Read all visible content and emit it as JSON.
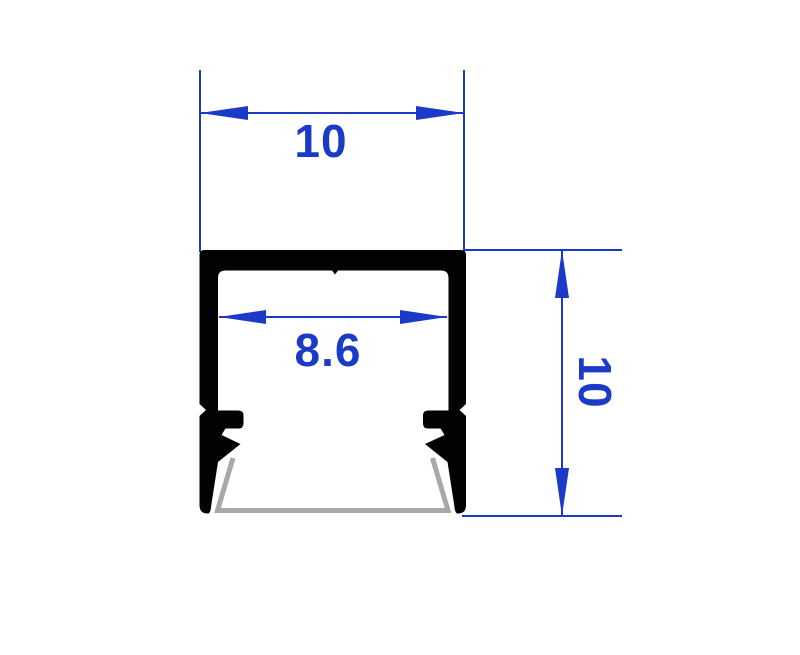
{
  "drawing": {
    "title": "LED profile cross-section",
    "dimensions": {
      "outer_width": {
        "label": "10",
        "value": 10
      },
      "inner_width": {
        "label": "8.6",
        "value": 8.6
      },
      "height": {
        "label": "10",
        "value": 10
      }
    },
    "colors": {
      "dimension_blue": "#1c3ac8",
      "profile_black": "#020202",
      "diffuser_gray": "#a8a8a8",
      "background": "#ffffff"
    }
  }
}
